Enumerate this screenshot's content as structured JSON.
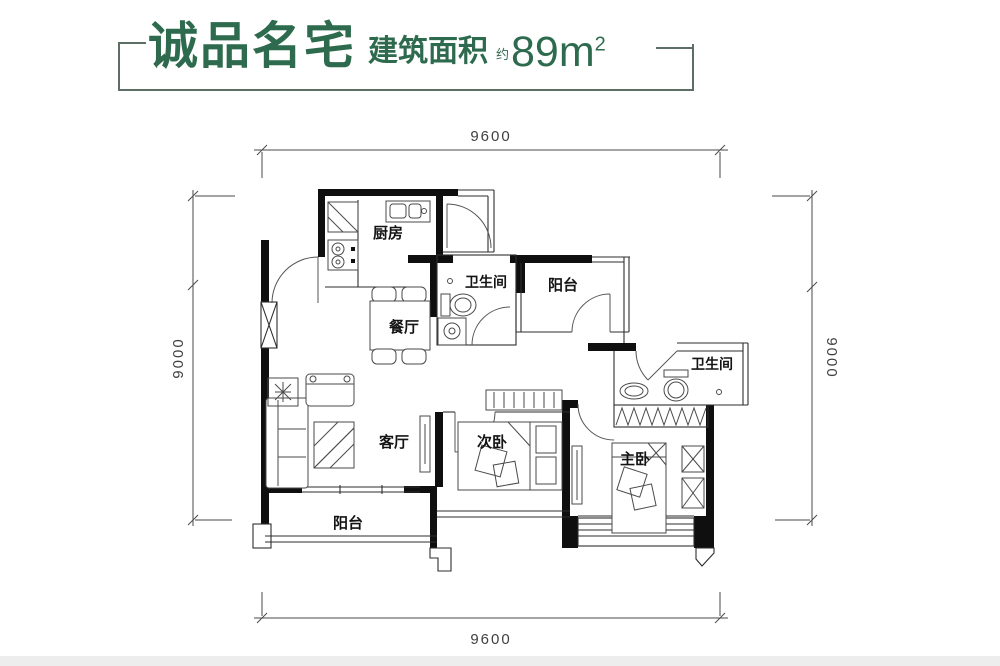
{
  "header": {
    "title": "诚品名宅",
    "area_label": "建筑面积",
    "approx_prefix": "约",
    "area_value": "89m",
    "area_exponent": "2"
  },
  "dimensions": {
    "top": "9600",
    "bottom": "9600",
    "left": "9000",
    "right": "9000"
  },
  "rooms": {
    "kitchen": "厨房",
    "bathroom_top": "卫生间",
    "balcony_top": "阳台",
    "dining": "餐厅",
    "living": "客厅",
    "bedroom_second": "次卧",
    "bedroom_master": "主卧",
    "bathroom_right": "卫生间",
    "balcony_bottom": "阳台"
  },
  "colors": {
    "accent_green": "#2e6b4e",
    "bracket_line": "#5d6e65",
    "wall_black": "#0f0f0f",
    "line_gray": "#3f3f3f",
    "background": "#ffffff"
  }
}
